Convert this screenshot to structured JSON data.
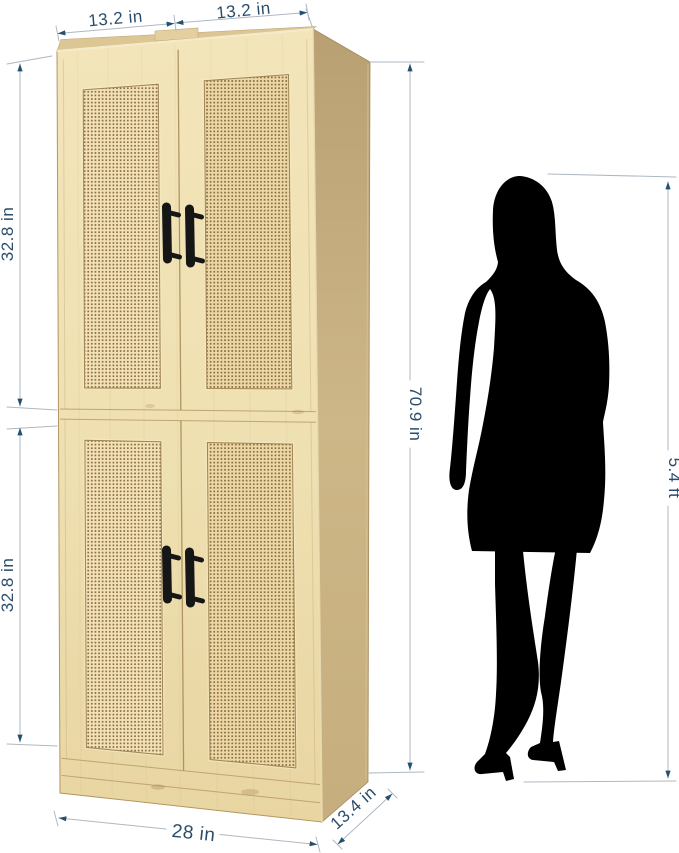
{
  "dims": {
    "top_width_left": "13.2 in",
    "top_width_right": "13.2 in",
    "upper_section_height": "32.8 in",
    "lower_section_height": "32.8 in",
    "total_height": "70.9 in",
    "bottom_width": "28 in",
    "depth": "13.4 in",
    "person_height": "5.4 ft"
  },
  "icons": {
    "figure": "woman-silhouette"
  },
  "colors": {
    "dimension_text": "#2b4d6b",
    "dimension_line": "#aeb8c2",
    "arrow": "#24506f",
    "wood_front_light": "#f3e5ba",
    "wood_front_dark": "#e8d5a2",
    "wood_side_top": "#b9a073",
    "wood_side_bottom": "#c6ae7e",
    "rattan_left_panel": "#f3e1b4",
    "rattan_right_panel": "#edd8a4",
    "rattan_hole": "#6f5433",
    "handle": "#161616",
    "silhouette": "#000000"
  }
}
